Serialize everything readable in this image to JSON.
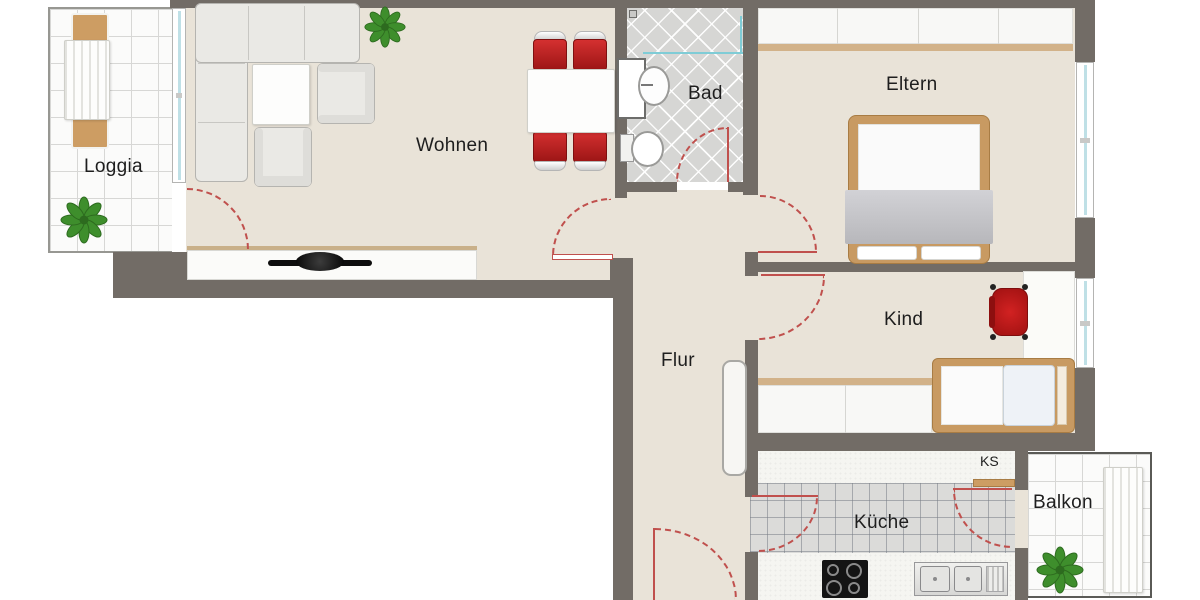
{
  "rooms": {
    "loggia": "Loggia",
    "wohnen": "Wohnen",
    "bad": "Bad",
    "eltern": "Eltern",
    "kind": "Kind",
    "flur": "Flur",
    "kueche": "Küche",
    "ks": "KS",
    "balkon": "Balkon"
  },
  "colors": {
    "wall": "#726c66",
    "floor": "#e9e3d8",
    "accent_red": "#c03030",
    "wood": "#cd9d63",
    "door_swing": "#c0504d",
    "window_glass": "#bfe0e6",
    "plant_green": "#3e8e2c"
  }
}
